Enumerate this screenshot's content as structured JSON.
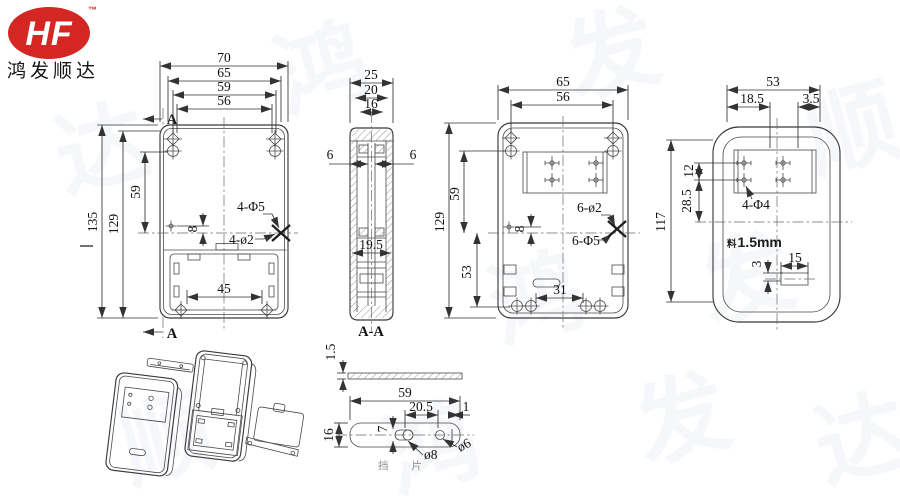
{
  "logo": {
    "hf": "HF",
    "tm": "™",
    "company": "鸿发顺达"
  },
  "front_view": {
    "dim_70": "70",
    "dim_65": "65",
    "dim_59_top": "59",
    "dim_56": "56",
    "dim_135": "135",
    "dim_129": "129",
    "dim_59_left": "59",
    "dim_8": "8",
    "dim_45": "45",
    "label_4d5": "4-Φ5",
    "label_4d2": "4-ø2",
    "section_a_top": "A",
    "section_a_bottom": "A"
  },
  "section_view": {
    "dim_25": "25",
    "dim_20": "20",
    "dim_16": "16",
    "dim_6_left": "6",
    "dim_6_right": "6",
    "dim_19_5": "19.5",
    "title": "A-A"
  },
  "back_view": {
    "dim_65": "65",
    "dim_56": "56",
    "dim_129": "129",
    "dim_59": "59",
    "dim_8": "8",
    "dim_53": "53",
    "dim_31": "31",
    "label_6d2": "6-ø2",
    "label_6d5": "6-Φ5"
  },
  "cover_view": {
    "dim_53": "53",
    "dim_18_5": "18.5",
    "dim_3_5": "3.5",
    "dim_117": "117",
    "dim_12": "12",
    "dim_28_5": "28.5",
    "label_4d4": "4-Φ4",
    "thick_prefix": "料",
    "thick_value": "1.5mm",
    "dim_3": "3",
    "dim_15": "15"
  },
  "baffle": {
    "dim_1_5": "1.5",
    "dim_59": "59",
    "dim_20_5": "20.5",
    "dim_1": "1",
    "dim_16": "16",
    "dim_7": "7",
    "label_d8": "ø8",
    "label_d6": "ø6",
    "part_name": "挡 片"
  },
  "watermark": {
    "w1": "鸿",
    "w2": "发",
    "w3": "顺",
    "w4": "达"
  }
}
